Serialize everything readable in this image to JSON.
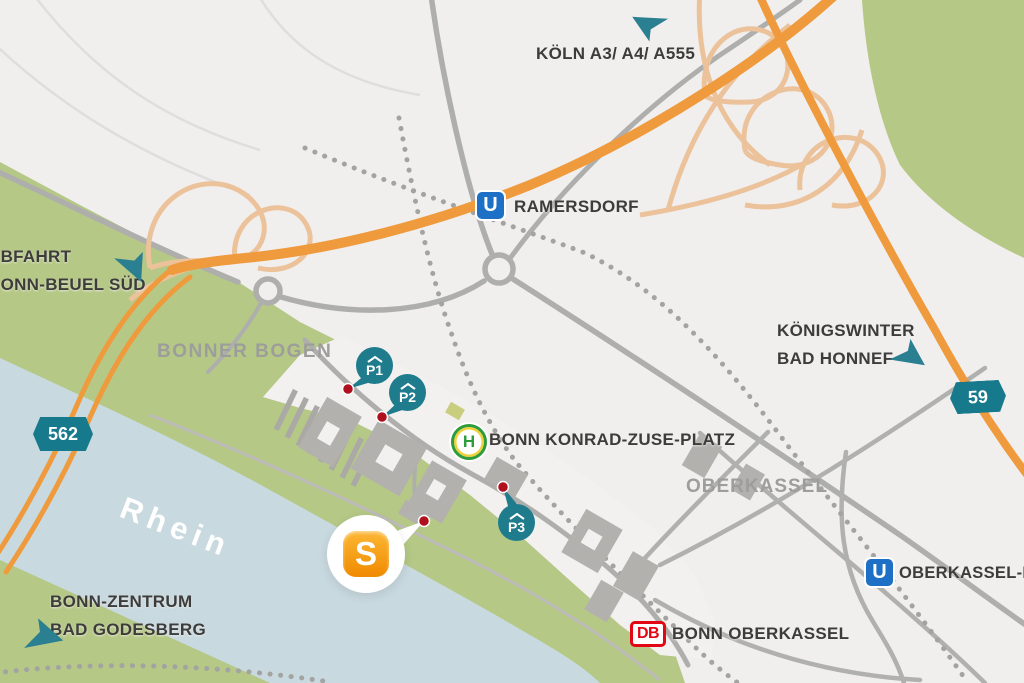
{
  "canvas": {
    "width": 1024,
    "height": 683
  },
  "colors": {
    "background": "#f0efee",
    "greenery": "#b5c886",
    "water": "#c8d9df",
    "road_gray": "#aeaeac",
    "rail_gray": "#a3a3a1",
    "highway_orange": "#ef9a3d",
    "ramp_orange": "#ecc29b",
    "teal_accent": "#1f7c8d",
    "ubahn_blue": "#1e70c6",
    "db_red": "#e30613",
    "stop_green": "#2e9c3c",
    "stop_yellow": "#f1d13b",
    "logo_orange": "#f29104",
    "anchor_red": "#b00f1e",
    "text_dark": "#3d3c3a",
    "text_gray": "#9d9d9b"
  },
  "destinations": {
    "koeln": "KÖLN A3/ A4/ A555",
    "exit_line1": "ABFAHRT",
    "exit_line2": "BONN-BEUEL SÜD",
    "koenigswinter_line1": "KÖNIGSWINTER",
    "koenigswinter_line2": "BAD HONNEF",
    "zentrum_line1": "BONN-ZENTRUM",
    "zentrum_line2": "BAD GODESBERG"
  },
  "areas": {
    "bonner_bogen": "BONNER BOGEN",
    "oberkassel": "OBERKASSEL",
    "rhein": "Rhein"
  },
  "stations": {
    "ramersdorf": {
      "icon": "U",
      "name": "RAMERSDORF"
    },
    "oberkassel_nord": {
      "icon": "U",
      "name": "OBERKASSEL-NORD"
    },
    "konrad_zuse": {
      "icon": "H",
      "name": "BONN KONRAD-ZUSE-PLATZ"
    },
    "bonn_oberkassel": {
      "icon": "DB",
      "name": "BONN OBERKASSEL"
    }
  },
  "road_signs": {
    "b562": "562",
    "b59": "59"
  },
  "parking": {
    "p1": "P1",
    "p2": "P2",
    "p3": "P3"
  },
  "logo": {
    "letter": "S"
  }
}
